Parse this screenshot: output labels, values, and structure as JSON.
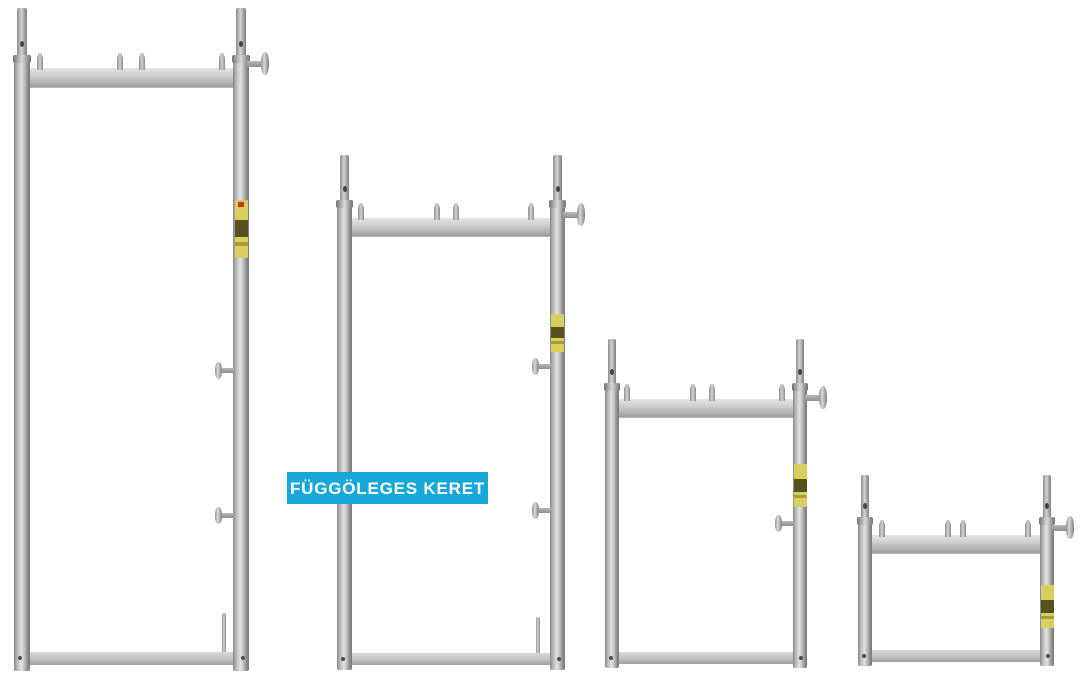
{
  "scene": {
    "background": "#ffffff",
    "subject": "four galvanized scaffolding vertical frames of decreasing height",
    "frame_count": 4
  },
  "caption_badge": {
    "text": "FÜGGÖLEGES KERET",
    "background": "#17a7d8",
    "text_color": "#ffffff"
  },
  "frames": [
    {
      "label": "vertical-frame-tallest"
    },
    {
      "label": "vertical-frame-tall"
    },
    {
      "label": "vertical-frame-medium"
    },
    {
      "label": "vertical-frame-short"
    }
  ],
  "palette": {
    "metal_light": "#e3e3e1",
    "metal_mid": "#b9b9b7",
    "metal_dark": "#77777b",
    "sticker_yellow": "#d9cf5e",
    "sticker_band": "#56511d",
    "sticker_red": "#c03a28"
  }
}
